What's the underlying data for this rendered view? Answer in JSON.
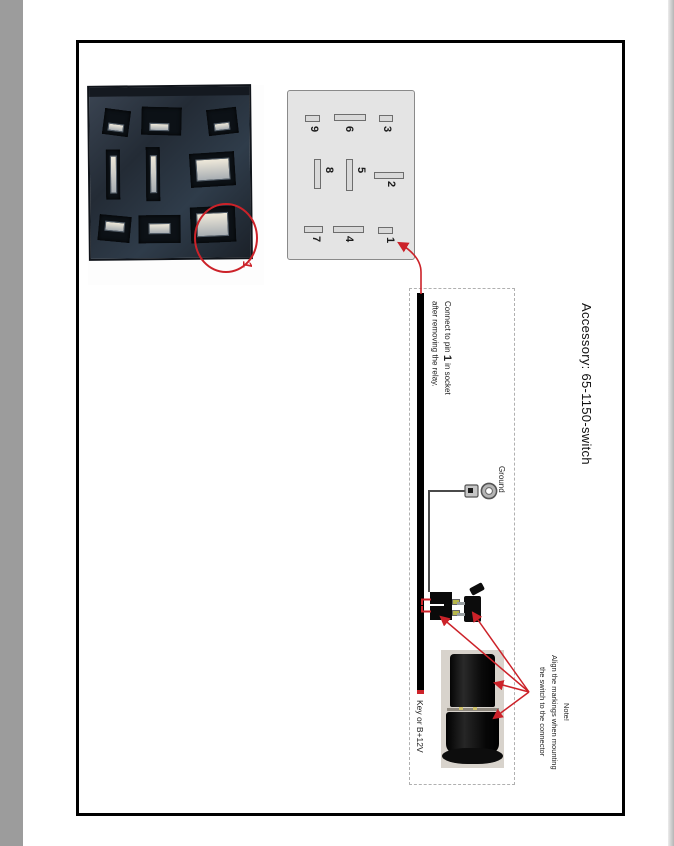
{
  "title": "Accessory: 65-1150-switch",
  "relay_photo": {
    "callout": "1"
  },
  "pin_diagram": {
    "pins": [
      "9",
      "6",
      "3",
      "8",
      "5",
      "2",
      "7",
      "4",
      "1"
    ]
  },
  "wiring": {
    "connect_pre": "Connect to pin ",
    "connect_pin": "1",
    "connect_post": " in socket",
    "connect_line2": "after removing the relay.",
    "ground": "Ground",
    "key": "Key or B+12V"
  },
  "note": {
    "line1": "Note!",
    "line2": "Align the markings when mounting",
    "line3": "the switch to the connector"
  },
  "colors": {
    "annotation_red": "#cc2229",
    "wire_black": "#000000",
    "dashed_border": "#b0b0b0",
    "diagram_bg": "#e4e4e4"
  }
}
